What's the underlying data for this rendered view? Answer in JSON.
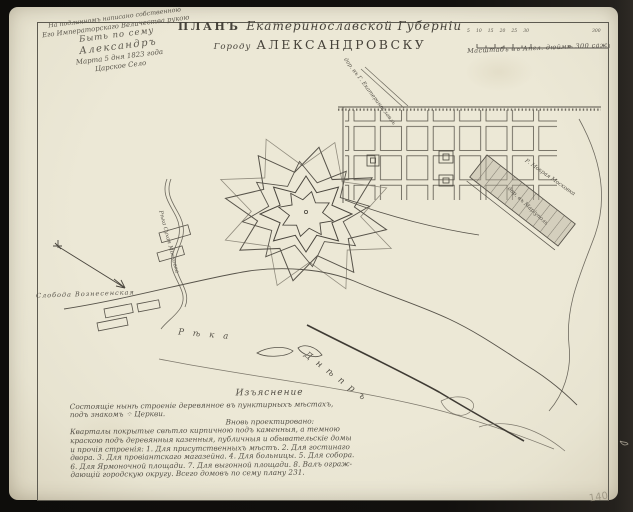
{
  "document": {
    "title": {
      "prefix": "ПЛАНЪ",
      "region": "Екатеринославской Губерніи",
      "city_prefix": "Городу",
      "city": "АЛЕКСАНДРОВСКУ"
    },
    "endorsement": {
      "line1": "На подлинномъ написано собственною",
      "line2": "Его Императорскаго Величества рукою",
      "line3": "Быть по сему",
      "line4": "Александръ",
      "line5": "Марта 5 дня 1823 года",
      "line6": "Царское Село"
    },
    "scale_bar": {
      "ticks": [
        "5",
        "10",
        "15",
        "20",
        "25",
        "30"
      ],
      "end_label": "300",
      "caption": "Масштабъ въ Англ. дюймѣ 300 саж."
    },
    "map_labels": {
      "river_word": "Рѣка",
      "dnieper": "Днѣпръ",
      "sukhaya_moskovka": "Рѣка Сухая Московка",
      "mokraya_moskovka": "Р. Мокрая Московка",
      "road_southeast": "дор. въ Маріуполь",
      "road_north": "дор. въ Г. Екатеринославль",
      "sloboda": "Слобода Вознесенская"
    },
    "legend": {
      "header": "Изъяснение",
      "lines": [
        "Состоящіе нынѣ строеніе деревянное въ пунктирныхъ мѣстахъ,",
        "подъ знакомъ ⁘ Церкви.",
        "Вновь проектировано:",
        "Кварталы покрытые свѣтло кирпичною подъ каменныя, а темною",
        "краскою подъ деревянныя казенныя, публичныя и обывательскіе домы",
        "и прочія строенія: 1. Для присутственныхъ мѣстъ. 2. Для гостинаго",
        "двора. 3. Для провіантскаго магазейна. 4. Для больницы. 5. Для собора.",
        "6. Для Ярмоночной площади. 7. Для выгонной площади. 8. Валъ ограж-",
        "дающій городскую округу. Всего домовъ по сему плану 231."
      ]
    },
    "annotations": {
      "page_number": "140"
    }
  }
}
